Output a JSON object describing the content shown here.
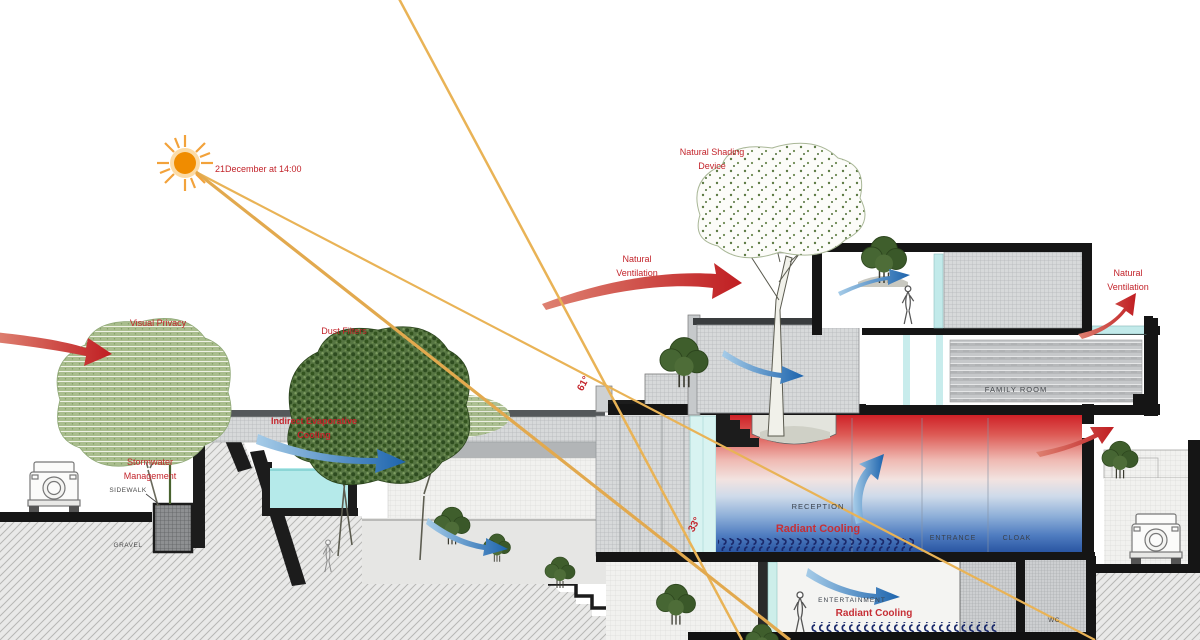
{
  "diagram": {
    "labels": {
      "sun_date": "21December at 14:00",
      "visual_privacy": "Visual Privacy",
      "dust_filters": "Dust Filters",
      "stormwater_1": "Stormwater",
      "stormwater_2": "Management",
      "sidewalk": "SIDEWALK",
      "gravel": "GRAVEL",
      "evap_1": "Indirect Evaporative",
      "evap_2": "Cooling",
      "nat_vent_1": "Natural",
      "nat_vent_2": "Ventilation",
      "shading_1": "Natural Shading",
      "shading_2": "Device",
      "angle_61": "61°",
      "angle_33": "33°",
      "reception": "RECEPTION",
      "radiant_cooling": "Radiant Cooling",
      "entrance": "ENTRANCE",
      "cloak": "CLOAK",
      "family_room": "FAMILY ROOM",
      "entertainment": "ENTERTAINMENT",
      "wc": "WC"
    },
    "colors": {
      "label_red": "#c3242b",
      "arrow_red": "#c01e22",
      "arrow_blue": "#1d64ad",
      "sun_orange": "#f08c00",
      "sun_ray": "#e9b356",
      "glass_cyan": "#c2eaea",
      "pool_cyan": "#b5eaea",
      "warm_top": "#cf2127",
      "cool_bottom": "#234f9d",
      "canopy_light": "#a9bd8d",
      "canopy_dark": "#4e6d38"
    }
  }
}
